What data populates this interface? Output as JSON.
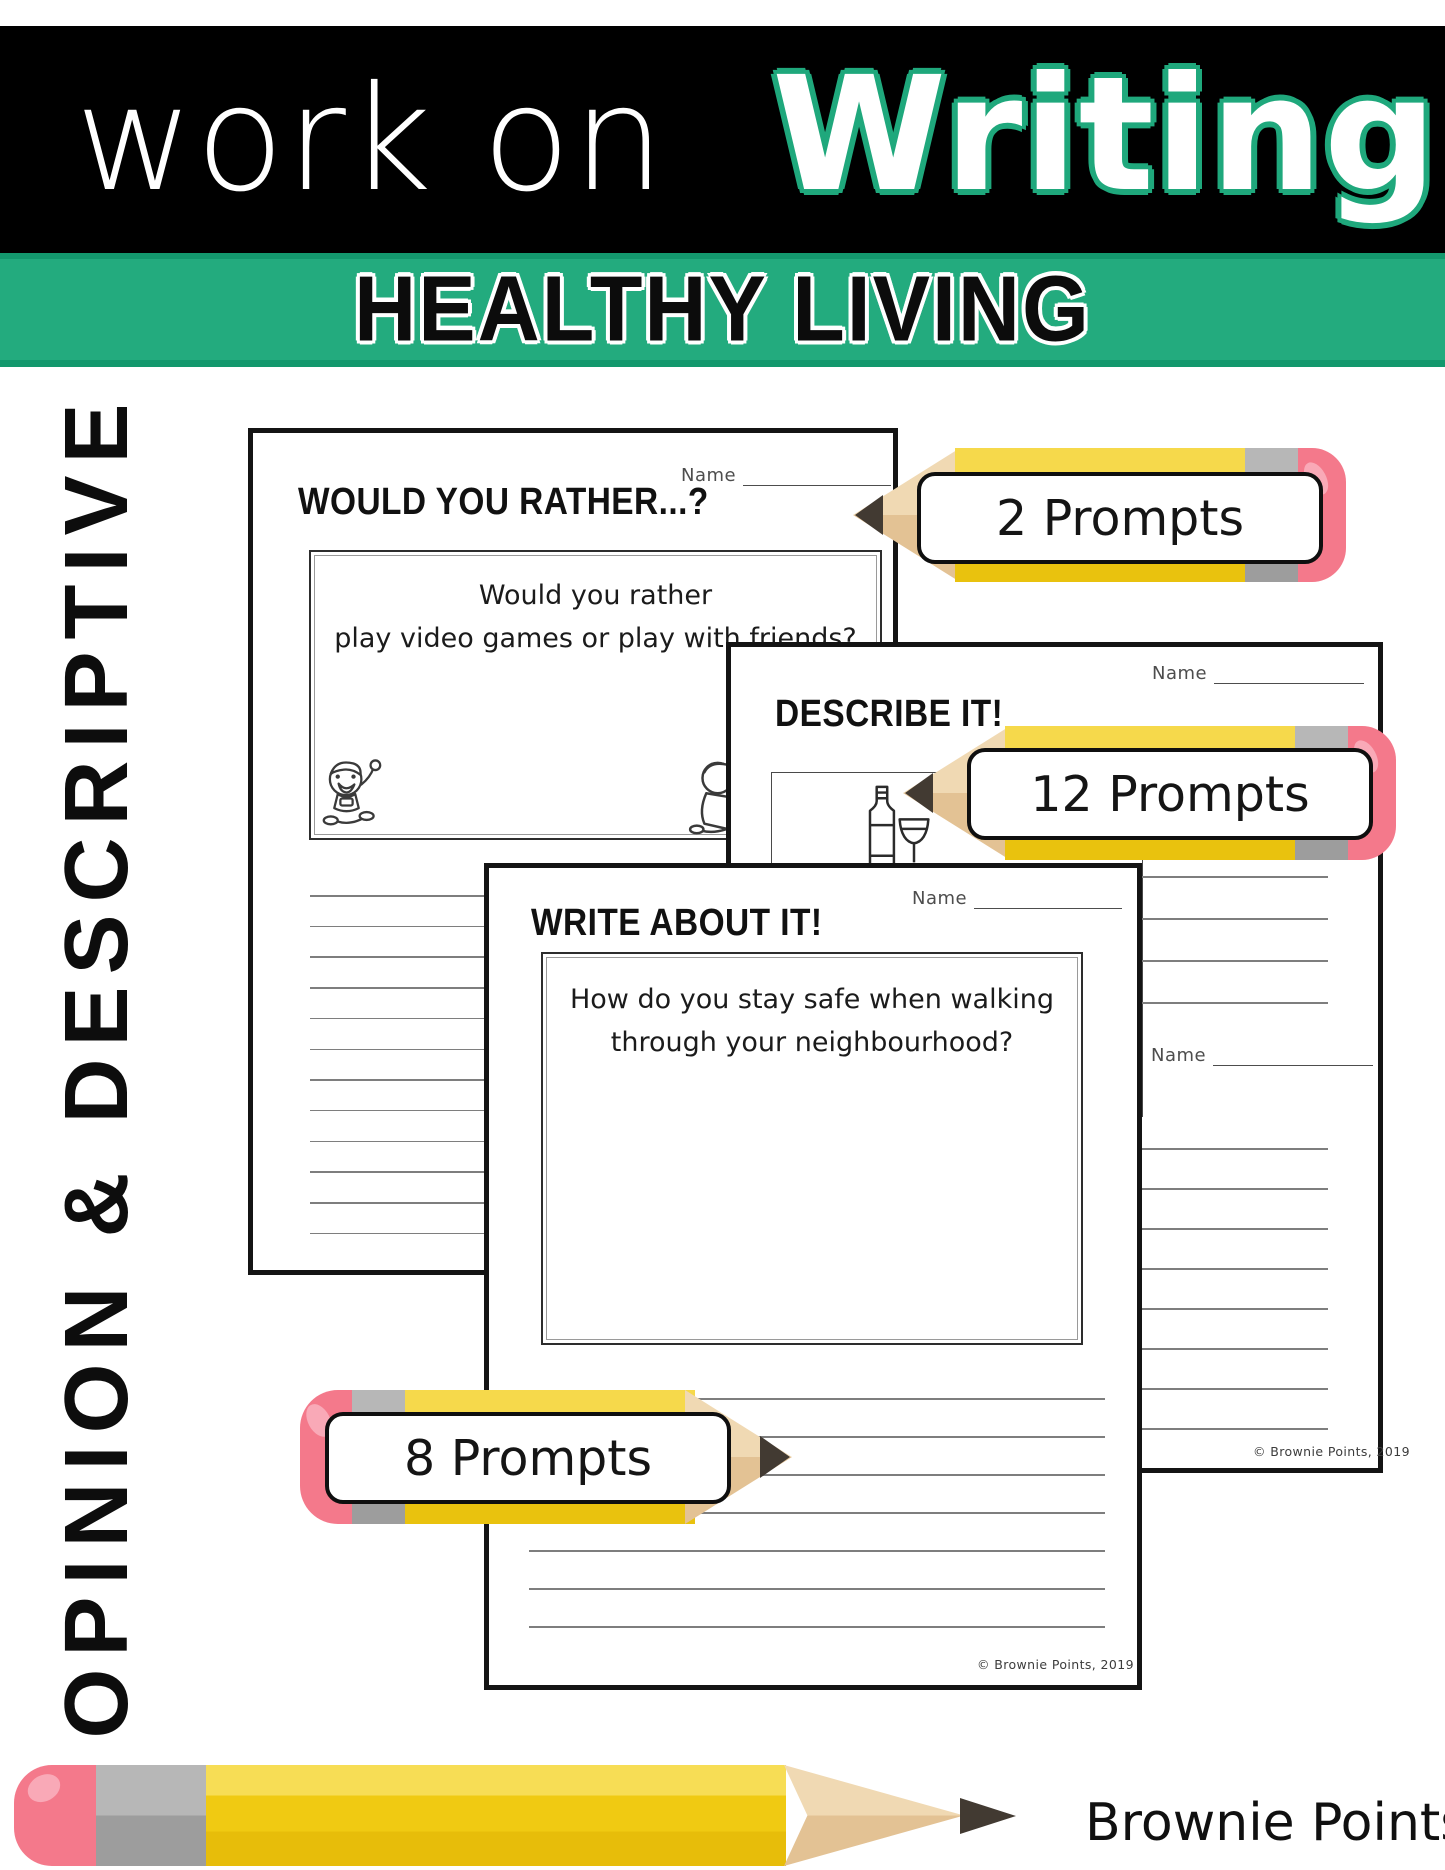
{
  "header": {
    "title_left": "work on",
    "title_right": "Writing",
    "subtitle": "HEALTHY LIVING"
  },
  "side_label": "OPINION & DESCRIPTIVE",
  "pages": {
    "would_you_rather": {
      "name_label": "Name",
      "title": "WOULD YOU RATHER...?",
      "prompt_line1": "Would you rather",
      "prompt_line2": "play video games or play with friends?"
    },
    "describe_it": {
      "name_label": "Name",
      "title": "DESCRIBE IT!",
      "second_name_label": "Name",
      "copyright": "© Brownie Points, 2019"
    },
    "write_about_it": {
      "name_label": "Name",
      "title": "WRITE ABOUT IT!",
      "prompt_line1": "How do you stay safe when walking",
      "prompt_line2": "through your neighbourhood?",
      "copyright": "© Brownie Points, 2019"
    }
  },
  "callouts": {
    "two": "2 Prompts",
    "twelve": "12 Prompts",
    "eight": "8 Prompts"
  },
  "brand": "Brownie Points",
  "colors": {
    "banner_green": "#1fa87c",
    "pencil_yellow_light": "#f6d94b",
    "pencil_yellow_dark": "#e9c20e",
    "pencil_wood": "#ebd1a8",
    "pencil_graphite": "#423a32",
    "pencil_ferrule": "#ababab",
    "pencil_eraser": "#f4798b"
  }
}
